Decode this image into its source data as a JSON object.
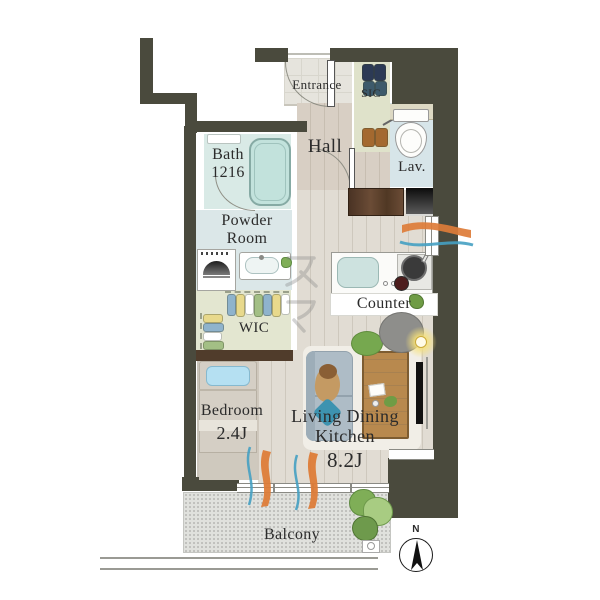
{
  "title": "apartment-floor-plan",
  "rooms": {
    "entrance": {
      "label": "Entrance"
    },
    "sic": {
      "label": "SIC"
    },
    "hall": {
      "label": "Hall"
    },
    "lav": {
      "label": "Lav."
    },
    "bath": {
      "name": "Bath",
      "size": "1216"
    },
    "powder": {
      "line1": "Powder",
      "line2": "Room"
    },
    "wic": {
      "label": "WIC"
    },
    "counter": {
      "label": "Counter"
    },
    "bedroom": {
      "name": "Bedroom",
      "size": "2.4J"
    },
    "ldk": {
      "line1": "Living Dining",
      "line2": "Kitchen",
      "size": "8.2J"
    },
    "balcony": {
      "label": "Balcony"
    }
  },
  "compass": {
    "label": "N"
  },
  "watermark": {
    "text": "スマ"
  },
  "colors": {
    "wall": "#4a4a3d",
    "entrance-floor": "#e6e4dd",
    "hall-floor": "#d8cfc4",
    "ldk-floor": "#e1dcd3",
    "bath-floor": "#d9eae6",
    "powder-floor": "#dbe7e8",
    "lav-floor": "#d7e5e9",
    "wic-floor": "#e3e6d0",
    "sic-floor": "#dfe2ca",
    "carpet": "#c8c2b8",
    "balcony-floor": "#e0e1dd",
    "airflow-orange": "#dd7c38",
    "airflow-blue": "#45a0c2",
    "sofa": "#aebcc6",
    "table-wood": "#b8894e",
    "accent-green": "#76a84f",
    "tub": "#c2e2dc"
  }
}
